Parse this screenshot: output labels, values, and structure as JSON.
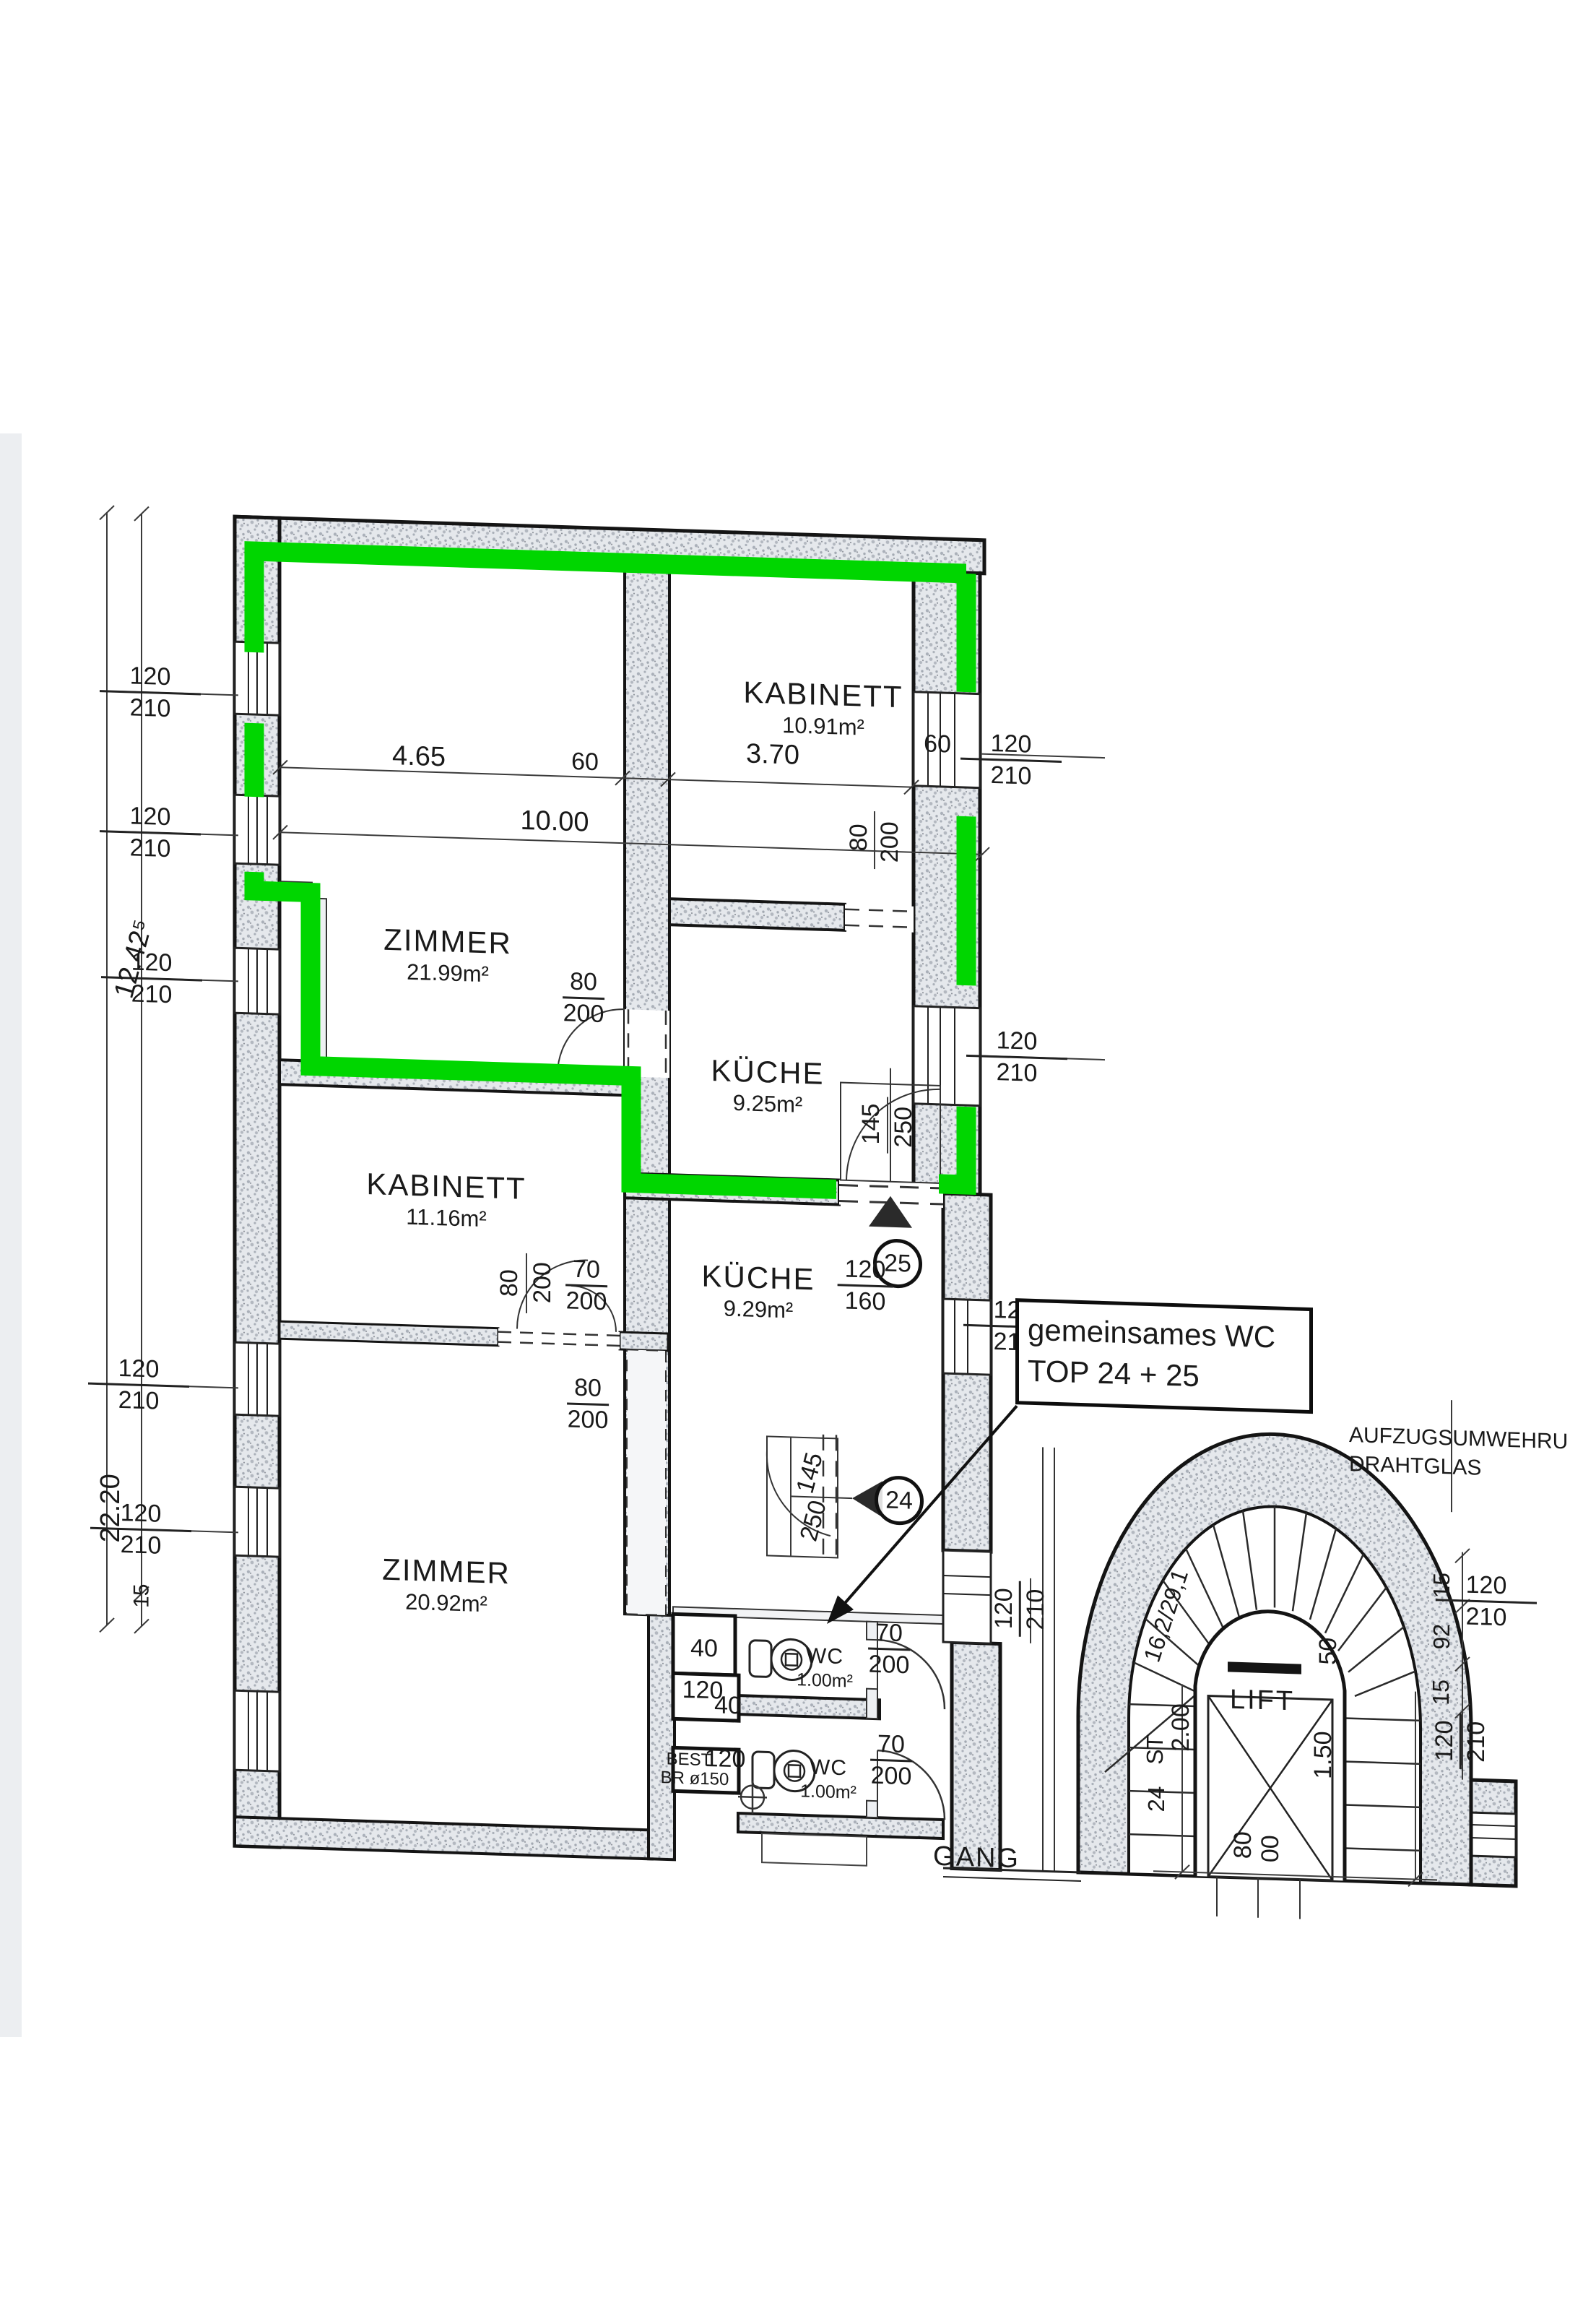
{
  "colors": {
    "highlight_green": "#00d600",
    "wall_fill": "#e5e8ec",
    "ink": "#1a1a1a"
  },
  "rooms": [
    {
      "name": "KABINETT",
      "area": "10.91m²"
    },
    {
      "name": "ZIMMER",
      "area": "21.99m²"
    },
    {
      "name": "KÜCHE",
      "area": "9.25m²"
    },
    {
      "name": "KABINETT",
      "area": "11.16m²"
    },
    {
      "name": "KÜCHE",
      "area": "9.29m²"
    },
    {
      "name": "ZIMMER",
      "area": "20.92m²"
    },
    {
      "name": "WC",
      "area": "1.00m²"
    },
    {
      "name": "WC",
      "area": "1.00m²"
    }
  ],
  "callout": {
    "line1": "gemeinsames WC",
    "line2": "TOP 24 + 25"
  },
  "markers": {
    "kueche_door": "25",
    "wc_door": "24"
  },
  "pairs": [
    {
      "a": "120",
      "b": "210"
    },
    {
      "a": "120",
      "b": "210"
    },
    {
      "a": "120",
      "b": "210"
    },
    {
      "a": "120",
      "b": "210"
    },
    {
      "a": "120",
      "b": "210"
    },
    {
      "a": "120",
      "b": "210"
    },
    {
      "a": "120",
      "b": "210"
    },
    {
      "a": "120",
      "b": "210"
    },
    {
      "a": "120",
      "b": "210"
    },
    {
      "a": "120",
      "b": "210"
    },
    {
      "a": "120",
      "b": "210"
    },
    {
      "a": "70",
      "b": "200"
    },
    {
      "a": "80",
      "b": "200"
    },
    {
      "a": "70",
      "b": "200"
    },
    {
      "a": "70",
      "b": "200"
    },
    {
      "a": "80",
      "b": "200"
    },
    {
      "a": "120",
      "b": "160"
    }
  ],
  "labels": {
    "dim_465": "4.65",
    "dim_60a": "60",
    "dim_370": "3.70",
    "dim_60b": "60",
    "dim_1000": "10.00",
    "rot_80": "80",
    "rot_200": "200",
    "rot_80b": "80",
    "rot_200b": "200",
    "door_145a": "145",
    "door_250a": "250",
    "door_145b": "145",
    "door_250b": "250",
    "dim_40a": "40",
    "dim_120a": "120",
    "dim_40b": "40",
    "dim_120b": "120",
    "best": "BEST.",
    "br": "BR ø150",
    "left_1242": "12.42⁵",
    "left_2220": "22.20",
    "left_15": "15",
    "aufzug_line1": "AUFZUGSUMWEHRU",
    "aufzug_line2": "DRAHTGLAS",
    "lift": "LIFT",
    "gang": "GANG",
    "stair_st": "ST",
    "stair_count": "24",
    "stair_ratio": "16,2/29,1",
    "stair_200": "2.00",
    "stair_150": "1.50",
    "stair_50": "50",
    "r_15a": "15",
    "r_92": "92",
    "r_15b": "15",
    "lift_80": "80",
    "lift_00": "00"
  }
}
